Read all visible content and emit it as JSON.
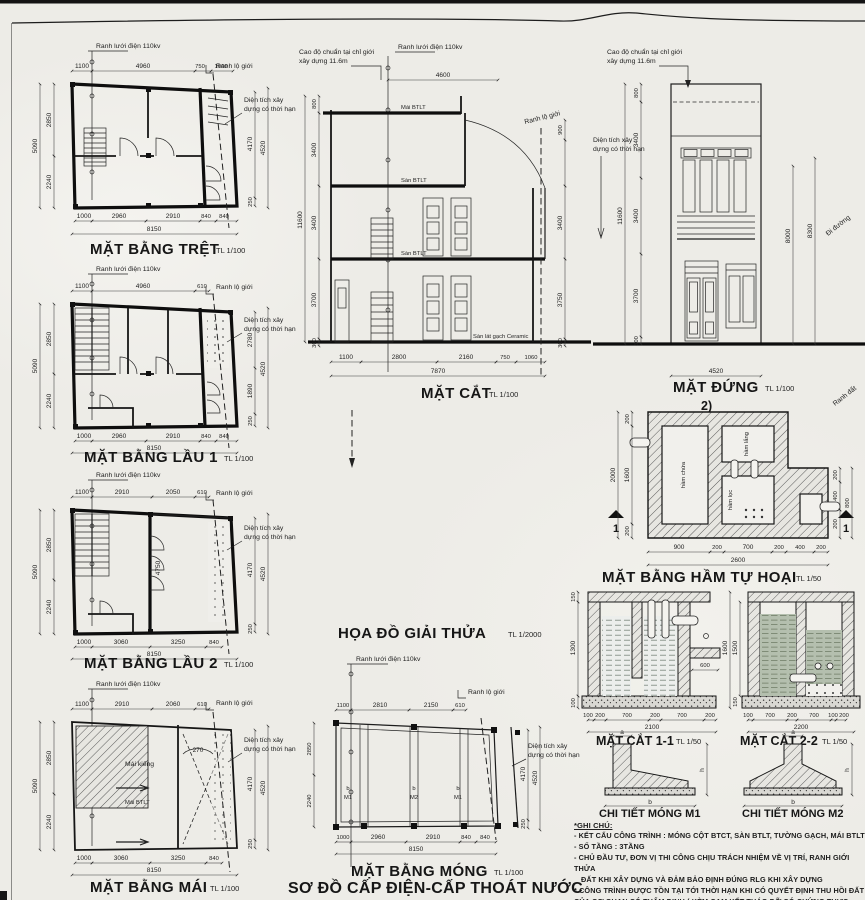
{
  "sheet": {
    "s100": "TL 1/100",
    "s50": "TL 1/50",
    "s2000": "TL 1/2000"
  },
  "common": {
    "grid110": "Ranh lưới điện 110kv",
    "road": "Ranh lộ giới",
    "area1": "Diện tích xây",
    "area2": "dựng có thời hạn",
    "datum1": "Cao độ chuẩn tại chỉ giới",
    "datum2": "xây dựng 11.6m"
  },
  "tret": {
    "title": "MẶT BẰNG TRỆT",
    "dims": {
      "t1": "1100",
      "t2": "4960",
      "t3": "750",
      "t4": "1060",
      "l0": "5090",
      "l1": "2850",
      "l2": "2240",
      "r1": "4170",
      "r2": "4520",
      "r3": "250",
      "b1": "1000",
      "b2": "2960",
      "b3": "2910",
      "b4": "840",
      "b5": "840",
      "total": "8150"
    }
  },
  "lau1": {
    "title": "MẶT BẰNG LẦU 1",
    "dims": {
      "t1": "1100",
      "t2": "4960",
      "t3": "610",
      "l0": "5090",
      "l1": "2850",
      "l2": "2240",
      "r1": "2780",
      "r2": "1890",
      "r3": "250",
      "r4": "4520",
      "b1": "1000",
      "b2": "2960",
      "b3": "2910",
      "b4": "840",
      "b5": "840",
      "total": "8150"
    }
  },
  "lau2": {
    "title": "MẶT BẰNG LẦU 2",
    "dims": {
      "t1": "1100",
      "t2": "2910",
      "t3": "2050",
      "t4": "610",
      "l0": "5090",
      "l1": "2850",
      "l2": "2240",
      "m1": "4750",
      "r1": "4170",
      "r2": "4520",
      "r3": "250",
      "b1": "1000",
      "b2": "3060",
      "b3": "3250",
      "b4": "840",
      "total": "8150"
    }
  },
  "mai": {
    "title": "MẶT BẰNG MÁI",
    "labels": {
      "kieng": "Mái kiếng",
      "btlt": "Mái BTLT",
      "angle": "270"
    },
    "dims": {
      "t1": "1100",
      "t2": "2910",
      "t3": "2060",
      "t4": "610",
      "l0": "5090",
      "l1": "2850",
      "l2": "2240",
      "r1": "4170",
      "r2": "4520",
      "r3": "250",
      "b1": "1000",
      "b2": "3060",
      "b3": "3250",
      "b4": "840",
      "total": "8150"
    }
  },
  "cat": {
    "title": "MẶT CẮT",
    "labels": {
      "mai": "Mái BTLT",
      "san": "Sàn BTLT",
      "ceramic": "Sàn lát gạch Ceramic"
    },
    "dims": {
      "top": "4600",
      "l0": "11600",
      "l1": "800",
      "l2": "3400",
      "l3": "3400",
      "l4": "3700",
      "l5": "300",
      "r1": "900",
      "r2": "3400",
      "r3": "3750",
      "r4": "300",
      "b1": "1100",
      "b2": "2800",
      "b3": "2160",
      "b4": "750",
      "b5": "1060",
      "total": "7870"
    }
  },
  "dung": {
    "title": "MẶT ĐỨNG",
    "mark": "2)",
    "street": "Đi đường",
    "ranh": "Ranh đất",
    "dims": {
      "l0": "11600",
      "l1": "800",
      "l2": "3400",
      "l3": "3400",
      "l4": "3700",
      "l5": "300",
      "r1": "8000",
      "r2": "8300",
      "bottom": "4520"
    }
  },
  "ham": {
    "title": "MẶT BẰNG HẦM TỰ HOẠI",
    "mark": "1",
    "rooms": {
      "chua": "hầm chứa",
      "lang": "hầm lắng",
      "loc": "hầm lọc"
    },
    "dims": {
      "l0": "2000",
      "l1": "200",
      "l2": "1600",
      "l3": "200",
      "b1": "900",
      "b2": "200",
      "b3": "700",
      "b4": "200",
      "b5": "400",
      "b6": "200",
      "total": "2600",
      "r0": "800",
      "r1": "200",
      "r2": "400",
      "r3": "200"
    }
  },
  "cat11": {
    "title": "MẶT CẮT 1-1",
    "dims": {
      "l1": "150",
      "l2": "1300",
      "l3": "100",
      "side": "600",
      "b1": "100",
      "b2": "200",
      "b3": "700",
      "b4": "200",
      "b5": "700",
      "b6": "200",
      "total": "2100"
    }
  },
  "cat22": {
    "title": "MẶT CẮT 2-2",
    "dims": {
      "l0": "1600",
      "l1": "1500",
      "l2": "150",
      "b1": "100",
      "b2": "700",
      "b3": "200",
      "b4": "700",
      "b5": "100",
      "b6": "200",
      "total": "2200"
    }
  },
  "m1": {
    "title": "CHI TIẾT MÓNG M1",
    "a": "a",
    "b": "b",
    "h": "h"
  },
  "m2": {
    "title": "CHI TIẾT MÓNG M2",
    "a": "a",
    "b": "b",
    "h": "h"
  },
  "giaithua": {
    "title": "HỌA ĐỒ GIẢI THỬA"
  },
  "mong": {
    "title": "MẶT BẰNG MÓNG",
    "f1": "M1",
    "f2": "M2",
    "f3": "M1",
    "bmark": "b",
    "dims": {
      "t1": "1100",
      "t2": "2810",
      "t3": "2150",
      "t4": "610",
      "l1": "2850",
      "l2": "2240",
      "r1": "4170",
      "r2": "4520",
      "r3": "250",
      "b1": "1000",
      "b2": "2960",
      "b3": "2910",
      "b4": "840",
      "b5": "840",
      "total": "8150"
    }
  },
  "sodo": {
    "title": "SƠ ĐỒ CẤP ĐIỆN-CẤP THOÁT NƯỚC"
  },
  "notes": {
    "heading": "*GHI CHÚ:",
    "l1": "- KẾT CẤU CÔNG TRÌNH : MÓNG CỘT BTCT, SÀN BTLT, TƯỜNG GẠCH, MÁI BTLT",
    "l2": "- SỐ TẦNG : 3TẦNG",
    "l3": "- CHỦ ĐẦU TƯ, ĐƠN VỊ THI CÔNG CHỊU TRÁCH NHIỆM VỀ VỊ TRÍ, RANH GIỚI THỬA",
    "l4": "ĐẤT KHI XÂY DỰNG VÀ ĐẢM BẢO ĐỊNH ĐÚNG RLG KHI XÂY DỰNG",
    "l5": "* CÔNG TRÌNH ĐƯỢC TỒN TẠI TỚI THỜI HẠN KHI CÓ QUYẾT ĐỊNH THU HỒI ĐẤT",
    "l6": "CỦA CƠ QUAN CÓ THẨM ĐỊNH ( KÈM CAM KẾT THÁO DỠ CÓ CHỨNG THỰC CHỮ KÝ"
  }
}
